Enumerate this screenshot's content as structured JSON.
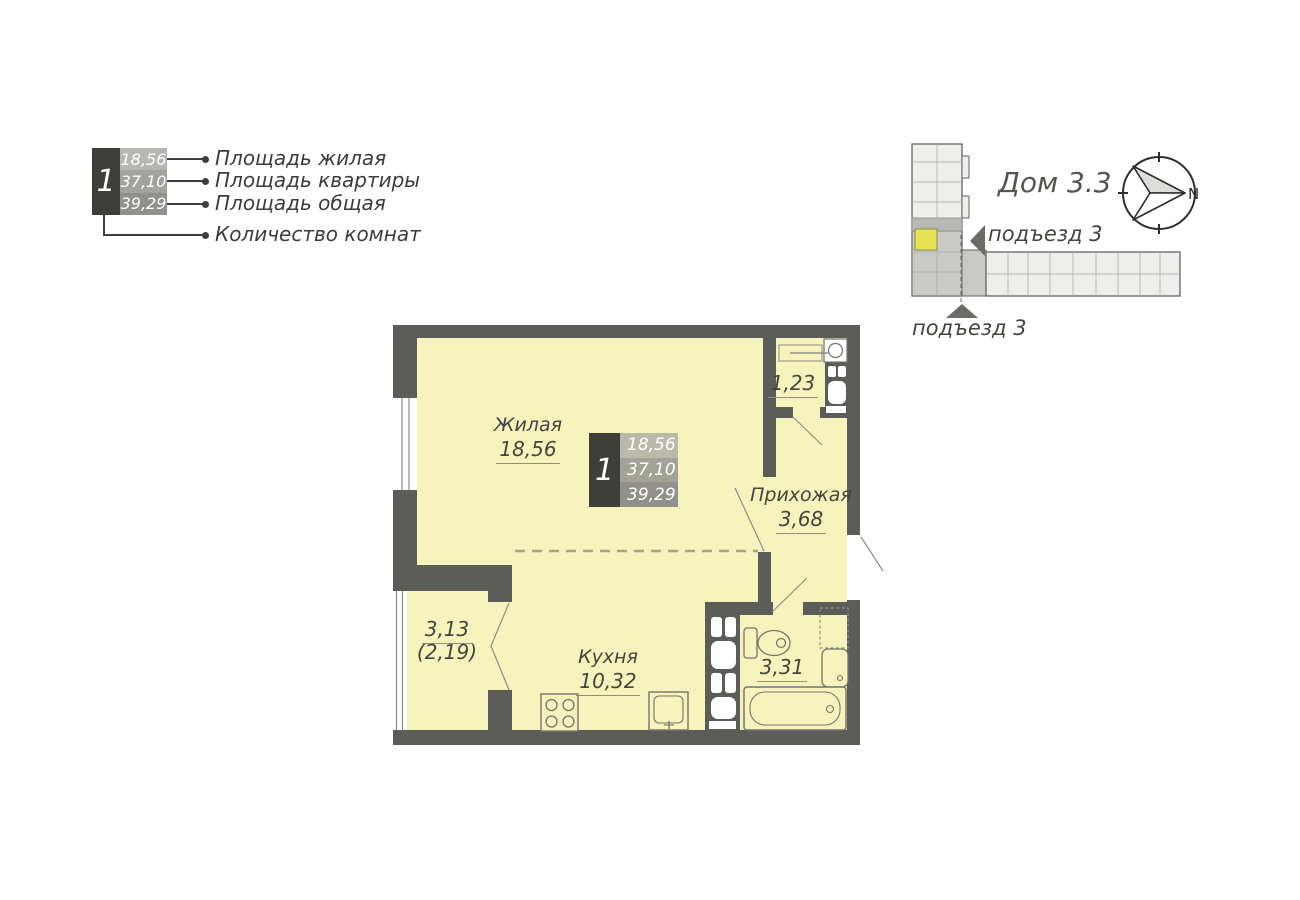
{
  "apartment": {
    "rooms_count": "1",
    "area_living": "18,56",
    "area_flat": "37,10",
    "area_total": "39,29"
  },
  "legend": {
    "label_area_living": "Площадь жилая",
    "label_area_flat": "Площадь квартиры",
    "label_area_total": "Площадь общая",
    "label_rooms_count": "Количество комнат"
  },
  "locator": {
    "house_title": "Дом 3.3",
    "entrance_side": "подъезд 3",
    "entrance_bottom": "подъезд 3",
    "compass_north": "N"
  },
  "plan": {
    "living": {
      "name": "Жилая",
      "area": "18,56"
    },
    "kitchen": {
      "name": "Кухня",
      "area": "10,32"
    },
    "hallway": {
      "name": "Прихожая",
      "area": "3,68"
    },
    "wc": {
      "area": "1,23"
    },
    "bathroom": {
      "area": "3,31"
    },
    "balcony": {
      "area": "3,13",
      "area_coef": "(2,19)"
    }
  },
  "colors": {
    "room_fill": "#f6f3bd",
    "wall": "#5c5c58",
    "highlight_flat": "#e7e253",
    "info_dark": "#3e3e3a",
    "building_fill": "#eeeeec",
    "building_section": "#c9c9c5"
  }
}
